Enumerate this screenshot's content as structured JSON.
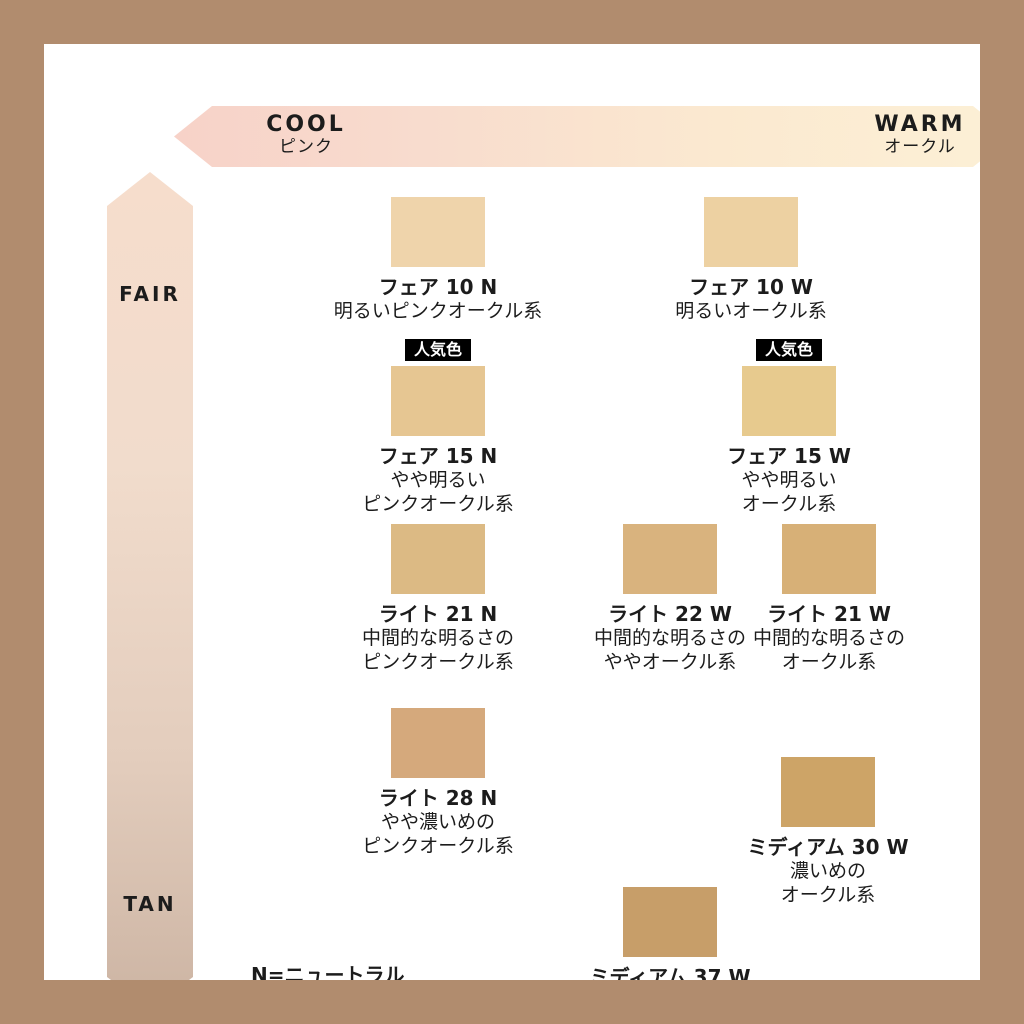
{
  "frame": {
    "border_color": "#b18c6e",
    "background": "#ffffff"
  },
  "axes": {
    "horizontal": {
      "left_label": "COOL",
      "left_sublabel": "ピンク",
      "right_label": "WARM",
      "right_sublabel": "オークル",
      "gradient_start": "#f7d2c8",
      "gradient_end": "#fcf0d6"
    },
    "vertical": {
      "top_label": "FAIR",
      "bottom_label": "TAN",
      "gradient_start": "#f6ddcc",
      "gradient_end": "#ccb4a3"
    }
  },
  "badge_label": "人気色",
  "legend": {
    "line1": "N=ニュートラル",
    "line2": "W=ウォーム"
  },
  "shades": [
    {
      "name": "フェア 10 N",
      "desc1": "明るいピンクオークル系",
      "color": "#efd4ab",
      "popular": false
    },
    {
      "name": "フェア 10 W",
      "desc1": "明るいオークル系",
      "color": "#edd1a2",
      "popular": false
    },
    {
      "name": "フェア 15 N",
      "desc1": "やや明るい",
      "desc2": "ピンクオークル系",
      "color": "#e6c692",
      "popular": true
    },
    {
      "name": "フェア 15 W",
      "desc1": "やや明るい",
      "desc2": "オークル系",
      "color": "#e7ca8e",
      "popular": true
    },
    {
      "name": "ライト 21 N",
      "desc1": "中間的な明るさの",
      "desc2": "ピンクオークル系",
      "color": "#dcba84",
      "popular": false
    },
    {
      "name": "ライト 22 W",
      "desc1": "中間的な明るさの",
      "desc2": "ややオークル系",
      "color": "#d9b37e",
      "popular": false
    },
    {
      "name": "ライト 21 W",
      "desc1": "中間的な明るさの",
      "desc2": "オークル系",
      "color": "#d7b077",
      "popular": false
    },
    {
      "name": "ライト 28 N",
      "desc1": "やや濃いめの",
      "desc2": "ピンクオークル系",
      "color": "#d5a97c",
      "popular": false
    },
    {
      "name": "ミディアム 30 W",
      "desc1": "濃いめの",
      "desc2": "オークル系",
      "color": "#cda467",
      "popular": false
    },
    {
      "name": "ミディアム 37 W",
      "desc1": "濃いややオークル系",
      "color": "#c79e69",
      "popular": false
    }
  ]
}
